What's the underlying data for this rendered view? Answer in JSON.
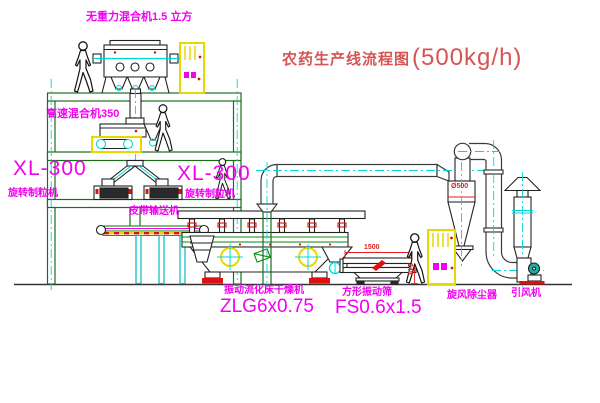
{
  "title": {
    "text": "农药生产线流程图",
    "capacity": "(500kg/h)"
  },
  "labels": {
    "gravity_mixer": "无重力混合机1.5 立方",
    "high_speed_mixer": "高速混合机350",
    "granulator_left_model": "XL-300",
    "granulator_left_name": "旋转制粒机",
    "granulator_right_model": "XL-300",
    "granulator_right_name": "旋转制粒机",
    "belt_conveyor": "皮带输送机",
    "dryer_name": "振动流化床干燥机",
    "dryer_model": "ZLG6x0.75",
    "sieve_name": "方形振动筛",
    "sieve_model": "FS0.6x1.5",
    "cyclone_name": "旋风除尘器",
    "fan_name": "引风机"
  },
  "dimensions": {
    "cyclone_diameter": "Ø500",
    "sieve_length": "1500",
    "sieve_height": "345"
  },
  "colors": {
    "label_magenta": "#f200f2",
    "title_red": "#d65454",
    "dimension_red": "#e02020",
    "structure_green": "#1c6e1c",
    "machine_black": "#222222",
    "centerline_cyan": "#00d8d8",
    "cabinet_yellow": "#e8d800",
    "motor_teal": "#1fb0a8",
    "accent_red": "#dd1111"
  }
}
